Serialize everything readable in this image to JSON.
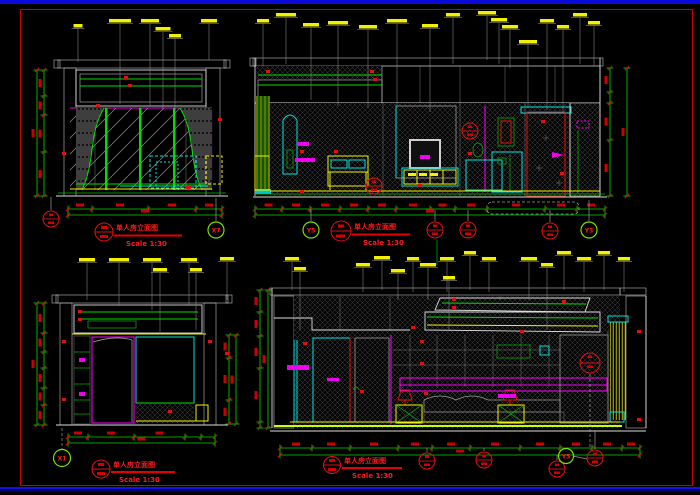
{
  "app": {
    "top_bar_color": "#0a0ad8",
    "bottom_bar_color": "#1212e8",
    "canvas_bg": "#000000",
    "sheet_frame_color": "#c40000"
  },
  "palette": {
    "dim_green": "#00dd00",
    "cyan": "#00e0e0",
    "magenta": "#f000f0",
    "annotation_yellow": "#f2f200",
    "marker_red": "#e81010",
    "outline_white": "#dcdcdc"
  },
  "drawings": [
    {
      "id": "window-wall-elevation",
      "title": "单人房立面图",
      "scale": "Scale 1:30"
    },
    {
      "id": "desk-tv-wall-elevation",
      "title": "单人房立面图",
      "scale": "Scale 1:30"
    },
    {
      "id": "wardrobe-wall-elevation",
      "title": "单人房立面图",
      "scale": "Scale 1:30"
    },
    {
      "id": "bed-wall-elevation",
      "title": "单人房立面图",
      "scale": "Scale 1:30"
    }
  ],
  "grid_bubbles": [
    {
      "label": "X7"
    },
    {
      "label": "Y5"
    },
    {
      "label": "Y3"
    },
    {
      "label": "X1"
    },
    {
      "label": "Y5"
    }
  ]
}
